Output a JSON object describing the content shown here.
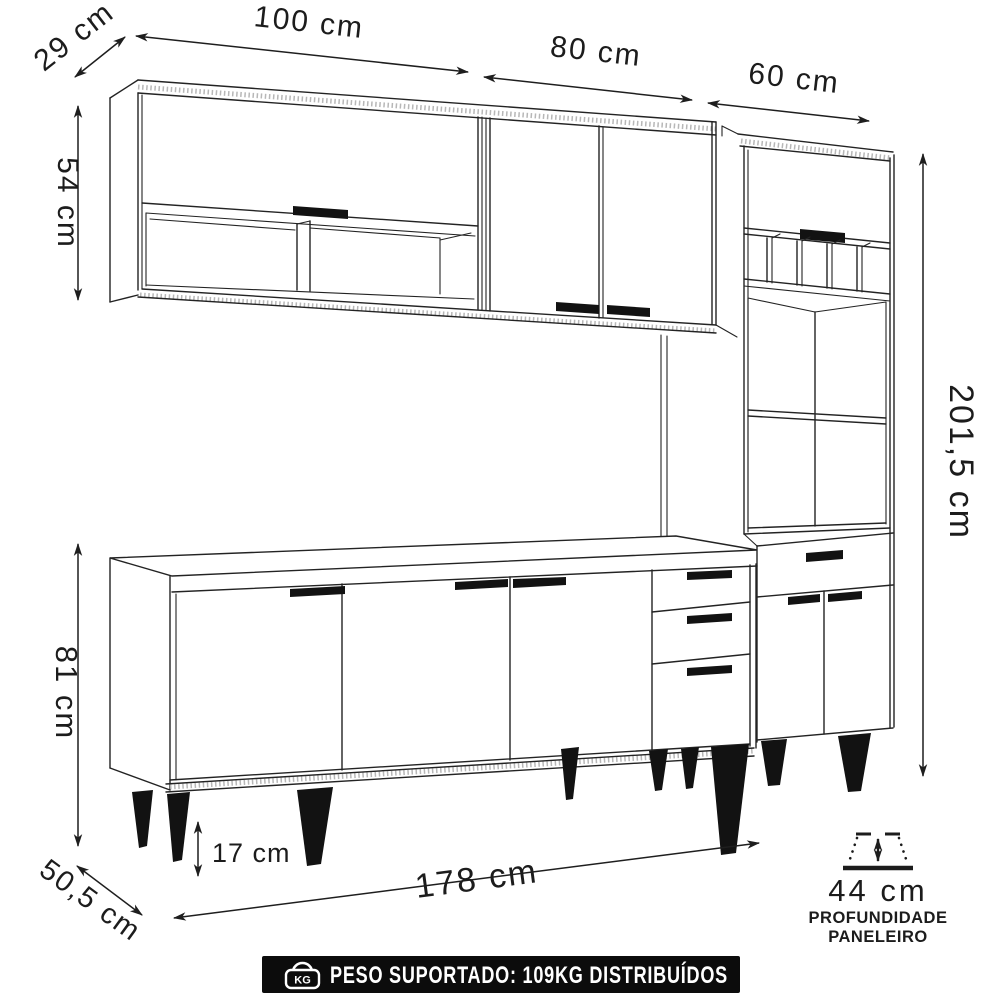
{
  "diagram": {
    "kind": "furniture-dimension-line-drawing",
    "line_color": "#232323",
    "background": "#ffffff"
  },
  "dimensions": {
    "wall_cabinet_depth": "29 cm",
    "wall_cabinet_left_width": "100 cm",
    "wall_cabinet_right_width": "80 cm",
    "tall_cabinet_width": "60 cm",
    "wall_cabinet_height": "54 cm",
    "total_height": "201,5 cm",
    "base_cabinet_height": "81 cm",
    "leg_height": "17 cm",
    "base_cabinet_width": "178 cm",
    "base_cabinet_depth": "50,5 cm",
    "paneleiro_depth": "44 cm"
  },
  "depth_note": {
    "line1": "PROFUNDIDADE",
    "line2": "PANELEIRO"
  },
  "banner": {
    "bg": "#0c0c0c",
    "text_color": "#ffffff",
    "icon_label": "KG",
    "text": "PESO SUPORTADO: 109KG DISTRIBUÍDOS"
  }
}
